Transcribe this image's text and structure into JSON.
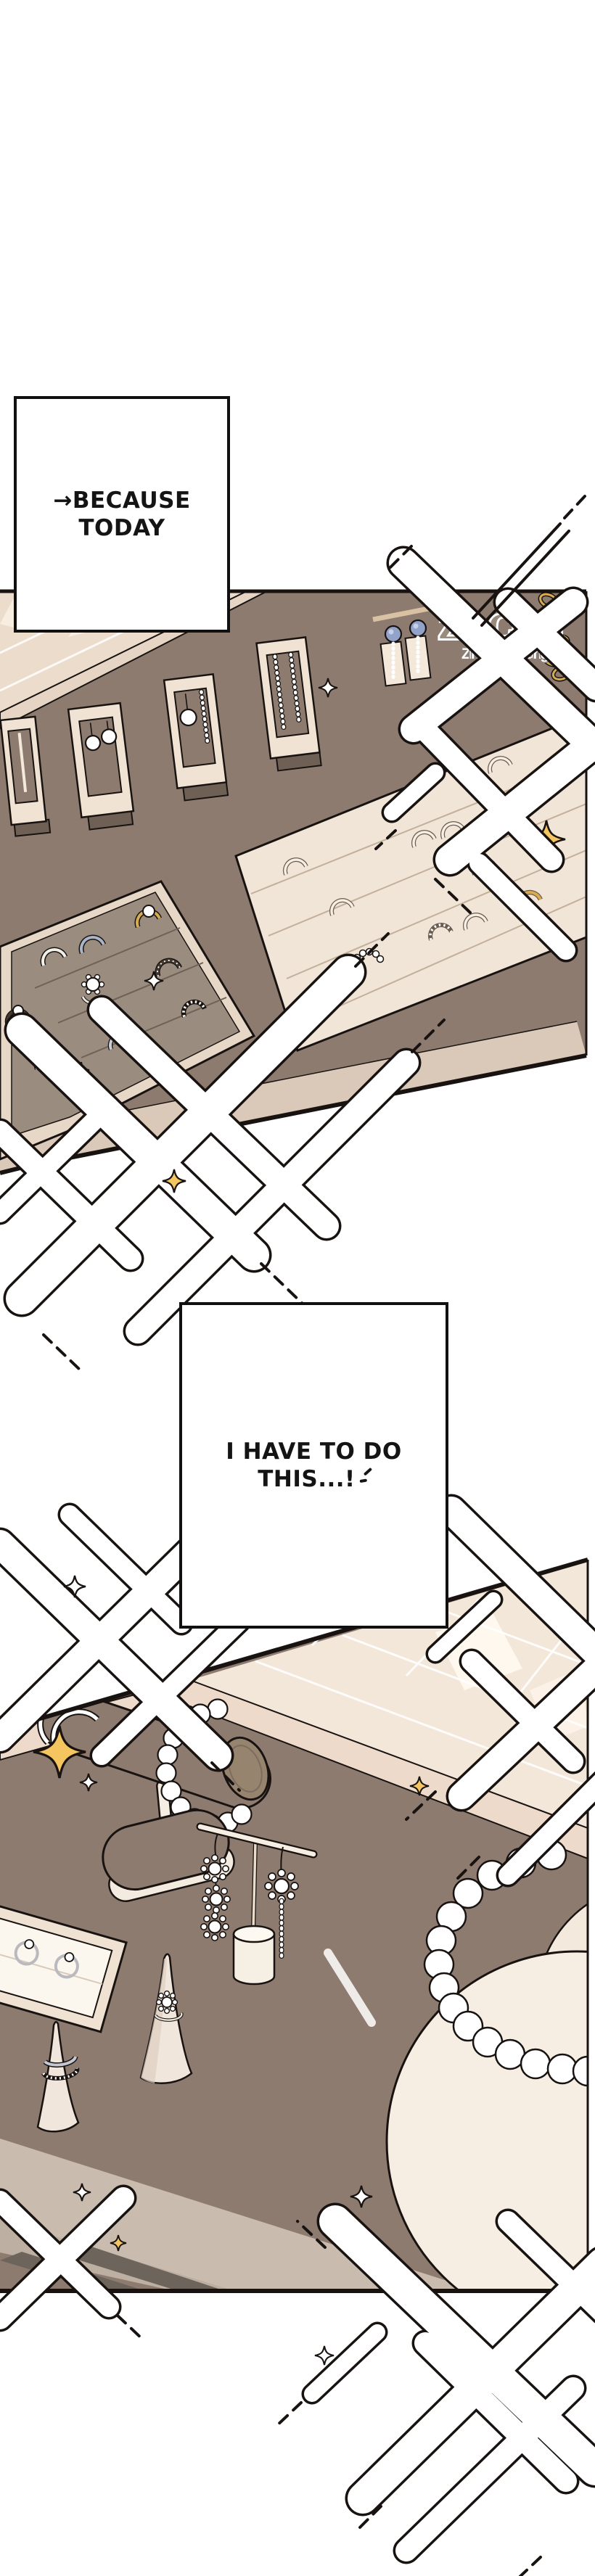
{
  "page": {
    "type": "webtoon comic page",
    "background": "#ffffff"
  },
  "speech_bubbles": [
    {
      "name": "bubble-1",
      "lines": [
        "→BECAUSE",
        "TODAY"
      ]
    },
    {
      "name": "bubble-2",
      "lines": [
        "I HAVE TO DO",
        "THIS...!"
      ]
    }
  ],
  "watermark": {
    "title": "Zin Chan",
    "subtitle": "ZinChangmanga"
  },
  "panels": [
    {
      "name": "panel-1",
      "content": "jewelry shop wall displays with earrings and trays of rings"
    },
    {
      "name": "panel-2",
      "content": "counter close-up: bracelet roll stand, earring stand, ring cones, pearl necklace bust"
    }
  ],
  "colors": {
    "wall_taupe": "#8d7b70",
    "cream": "#f0e2d2",
    "tile": "#f3e7da",
    "tray_gray": "#9a8c7f",
    "light_band": "#c9bbad",
    "sparkle_gold": "#f5c55f",
    "chain_gold": "#d9ab50",
    "gem_blue": "#93a2c8",
    "line": "#181310"
  }
}
